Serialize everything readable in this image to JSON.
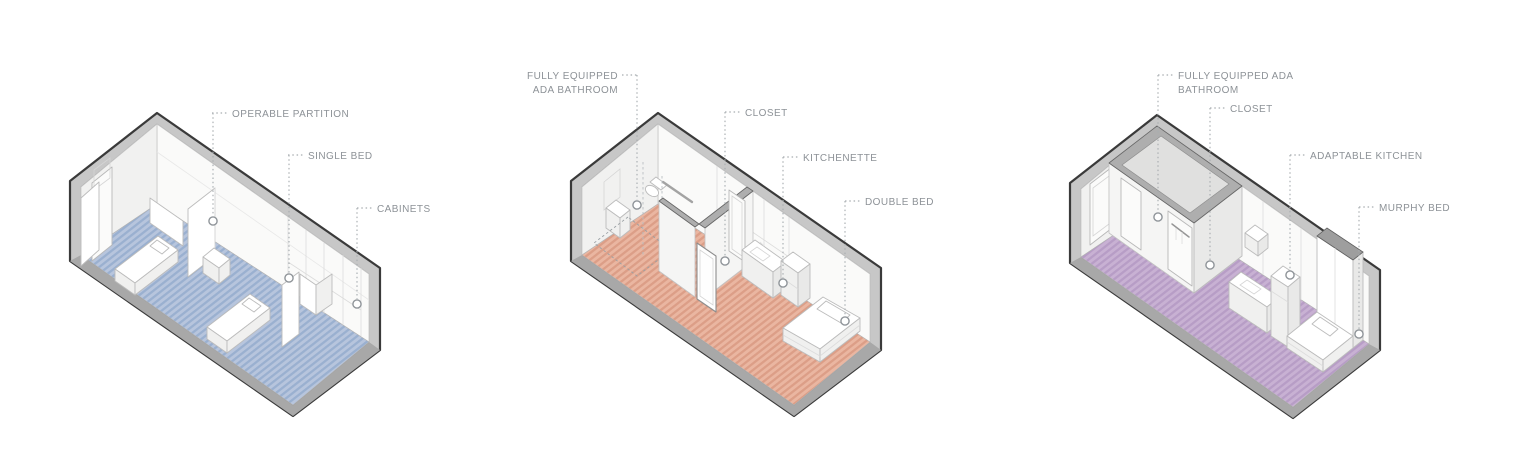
{
  "page": {
    "background": "#ffffff"
  },
  "style": {
    "css_vars": {
      "bg": "#ffffff",
      "band": "#c7c7c7",
      "slab": "#a8a8a8",
      "outline": "#3a3a3a",
      "inner_line": "#919191",
      "wall": "#fafaf9",
      "wall_end": "#f1f1f0",
      "iwall": "#f5f5f4",
      "furn": "#bcbcbc",
      "label": "#8d9297",
      "leader": "#a8adb1"
    }
  },
  "panels": [
    {
      "name": "shared-bedroom",
      "floor_base": "#b7c5dd",
      "floor_stripe": "#9ab0d0",
      "labels": {
        "operable_partition": "OPERABLE PARTITION",
        "single_bed": "SINGLE BED",
        "cabinets": "CABINETS"
      }
    },
    {
      "name": "ada-studio",
      "floor_base": "#eab6a1",
      "floor_stripe": "#dc9e87",
      "labels": {
        "bathroom_line1": "FULLY EQUIPPED",
        "bathroom_line2": "ADA BATHROOM",
        "closet": "CLOSET",
        "kitchenette": "KITCHENETTE",
        "double_bed": "DOUBLE BED"
      }
    },
    {
      "name": "murphy-studio",
      "floor_base": "#c8b1d3",
      "floor_stripe": "#b79dc6",
      "labels": {
        "bathroom_line1": "FULLY EQUIPPED ADA",
        "bathroom_line2": "BATHROOM",
        "closet": "CLOSET",
        "adaptable_kitchen": "ADAPTABLE KITCHEN",
        "murphy_bed": "MURPHY BED"
      }
    }
  ]
}
